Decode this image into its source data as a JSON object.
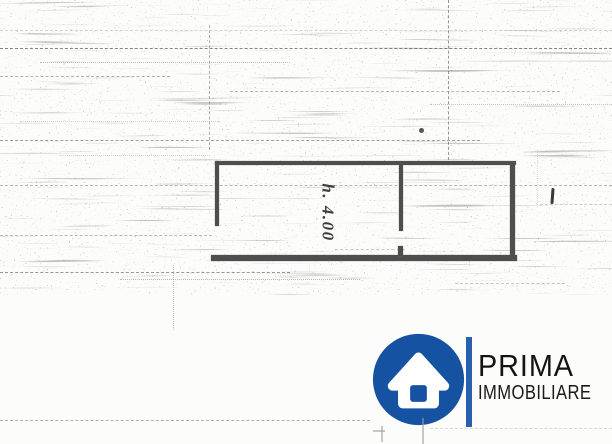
{
  "plan": {
    "height_annotation": "h. 4.00"
  },
  "logo": {
    "line1": "PRIMA",
    "line2": "IMMOBILIARE",
    "icon": "house-icon",
    "colors": {
      "circle": "#1553a2",
      "bar": "#2a5fae",
      "house": "#ffffff",
      "text": "#141414"
    }
  }
}
